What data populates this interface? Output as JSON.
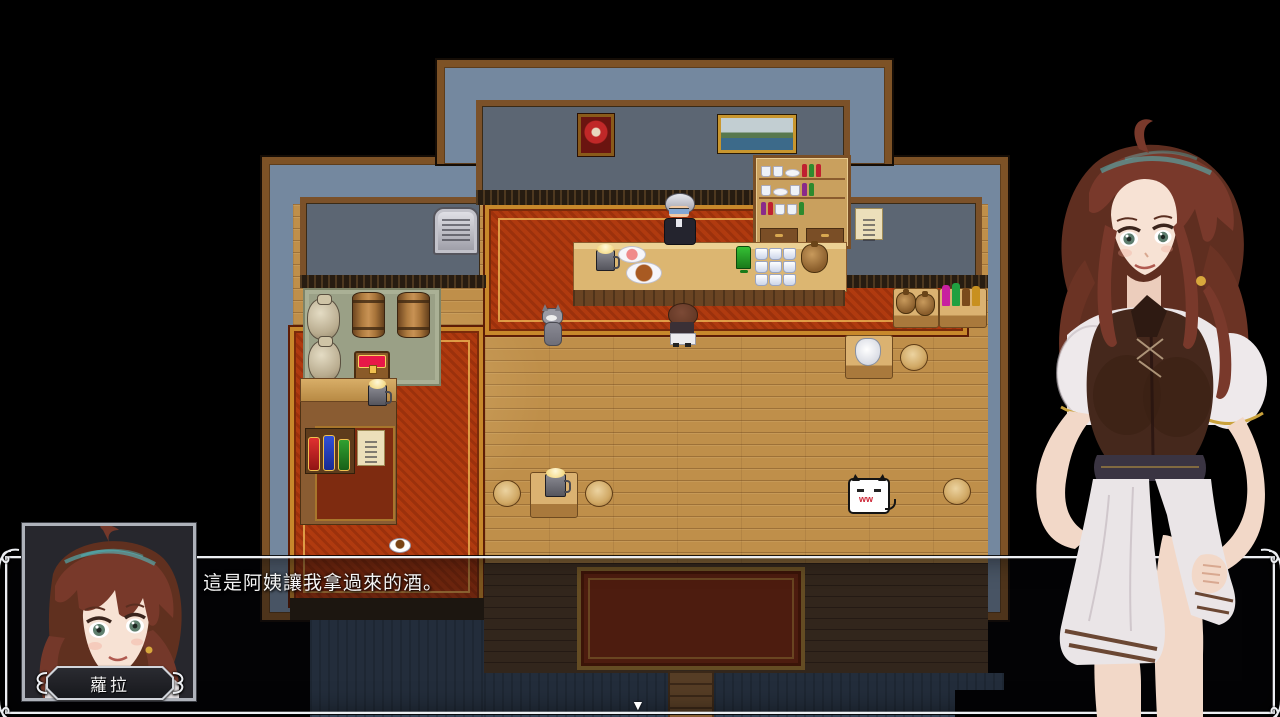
{
  "dialogue": {
    "speaker_name": "蘿拉",
    "text": "這是阿姨讓我拿過來的酒。",
    "continue_indicator": "▼"
  },
  "colors": {
    "background": "#000000",
    "wall_blue": "#74889f",
    "wood_border": "#7d5226",
    "interior_wall": "#5c6673",
    "floor_wood": "#bf8f4a",
    "carpet_red": "#b03a0f",
    "carpet_gold": "#c8882b",
    "ui_frame_silver": "#eceef2",
    "heroine_hair": "#74382a",
    "heroine_vest": "#45281c",
    "heroine_dress": "#eae5e7"
  }
}
